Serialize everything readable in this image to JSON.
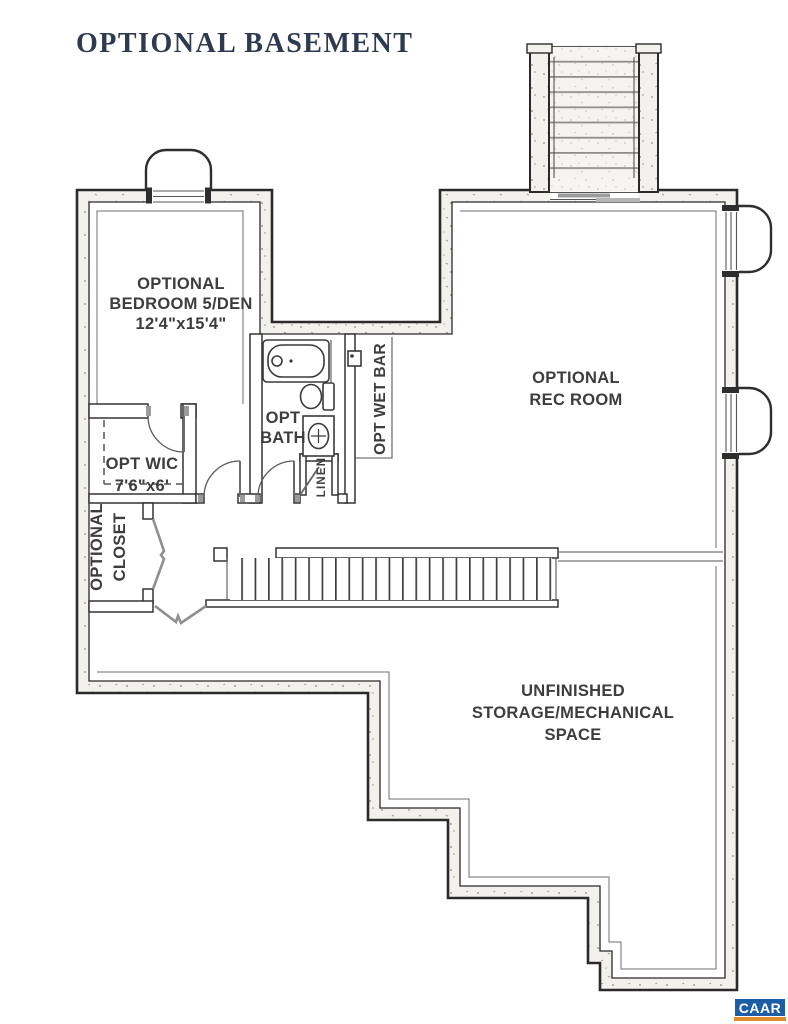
{
  "title": "OPTIONAL BASEMENT",
  "colors": {
    "title_navy": "#2d3a50",
    "label_gray": "#3d3d3d",
    "wall_fill": "#f2f1ed",
    "wall_line": "#2a2a2a",
    "logo_blue": "#1d5da6",
    "logo_orange": "#e08b2d"
  },
  "rooms": {
    "bedroom": {
      "lines": [
        "OPTIONAL",
        "BEDROOM 5/DEN",
        "12'4\"x15'4\""
      ]
    },
    "bath": {
      "lines": [
        "OPT",
        "BATH"
      ]
    },
    "wet_bar": {
      "label": "OPT WET BAR"
    },
    "wic": {
      "lines": [
        "OPT WIC",
        "7'6\"x6'"
      ]
    },
    "closet": {
      "lines": [
        "OPTIONAL",
        "CLOSET"
      ]
    },
    "linen": {
      "label": "LINEN"
    },
    "rec_room": {
      "lines": [
        "OPTIONAL",
        "REC ROOM"
      ]
    },
    "storage": {
      "lines": [
        "UNFINISHED",
        "STORAGE/MECHANICAL",
        "SPACE"
      ]
    }
  },
  "logo": {
    "text": "CAAR"
  }
}
